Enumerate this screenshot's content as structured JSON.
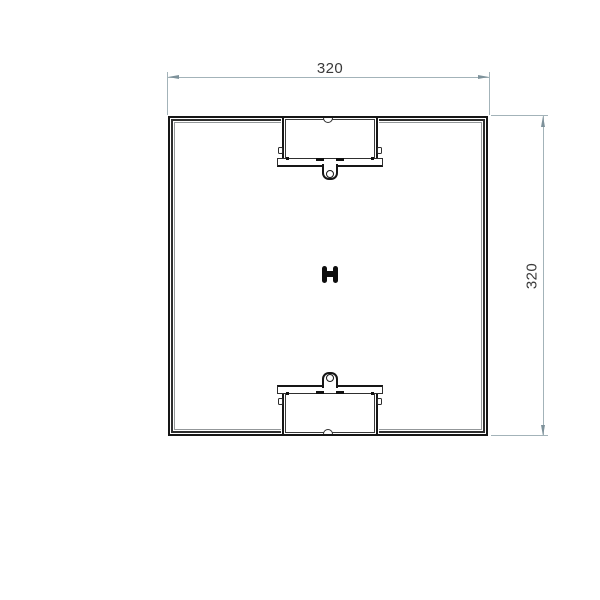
{
  "drawing": {
    "view": "top-view-square-profile",
    "dimensions": {
      "width": {
        "label": "320"
      },
      "height": {
        "label": "320"
      }
    },
    "features": {
      "outline": "square-profile-outline",
      "top_recess": "top-recess-pocket",
      "bottom_recess": "bottom-recess-pocket",
      "top_tab": "clip-tab-with-hole",
      "bottom_tab": "clip-tab-with-hole",
      "center": "center-fastener"
    },
    "colors": {
      "background": "#ffffff",
      "edge_dark": "#161616",
      "edge_medium": "#2e2e2e",
      "edge_light": "#939799",
      "dimension_line": "#a3b3b9",
      "dimension_arrow": "#7e929b",
      "dimension_text": "#3a3a3a"
    }
  }
}
